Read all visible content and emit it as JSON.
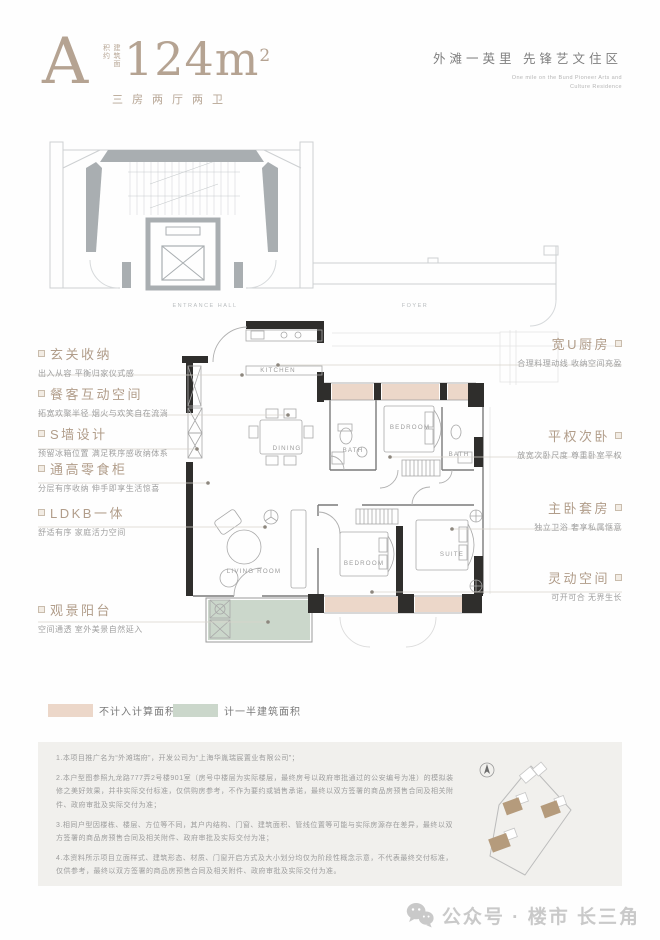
{
  "header": {
    "plan_letter": "A",
    "area_prefix": "建筑面积约",
    "area_value": "124m",
    "area_sup": "2",
    "layout": "三房两厅两卫",
    "tagline_cn": "外滩一英里  先锋艺文住区",
    "tagline_en_line1": "One mile on the Bund Pioneer Arts and",
    "tagline_en_line2": "Culture Residence"
  },
  "entrance": {
    "labels": [
      "ENTRANCE HALL",
      "FOYER"
    ]
  },
  "floorplan": {
    "rooms": [
      "KITCHEN",
      "DINING",
      "BATH",
      "BEDROOM",
      "BATH",
      "LIVING ROOM",
      "BEDROOM",
      "SUITE"
    ]
  },
  "callouts_left": [
    {
      "title": "玄关收纳",
      "desc": "出入从容 平衡归家仪式感"
    },
    {
      "title": "餐客互动空间",
      "desc": "拓宽欢聚半径 烟火与欢笑自在流淌"
    },
    {
      "title": "S墙设计",
      "desc": "预留冰箱位置 满足秩序感收纳体系"
    },
    {
      "title": "通高零食柜",
      "desc": "分层有序收纳 伸手即享生活惊喜"
    },
    {
      "title": "LDKB一体",
      "desc": "舒适有序 家庭活力空间"
    },
    {
      "title": "观景阳台",
      "desc": "空间通透 室外美景自然延入"
    }
  ],
  "callouts_right": [
    {
      "title": "宽U厨房",
      "desc": "合理料理动线 收纳空间充盈"
    },
    {
      "title": "平权次卧",
      "desc": "放宽次卧尺度 尊重卧室平权"
    },
    {
      "title": "主卧套房",
      "desc": "独立卫浴 奢享私属惬意"
    },
    {
      "title": "灵动空间",
      "desc": "可开可合 无界生长"
    }
  ],
  "legend": {
    "items": [
      {
        "label": "不计入计算面积",
        "color": "#ecd7c9"
      },
      {
        "label": "计一半建筑面积",
        "color": "#cbd7cb"
      }
    ]
  },
  "disclaimer": {
    "lines": [
      "1.本项目推广名为“外滩瑞府”，开发公司为“上海华胤瑞宸置业有限公司”；",
      "2.本户型图参照九龙路777弄2号楼901室（房号中楼层为实际楼层，最终房号以政府审批通过的公安编号为准）的模拟装修之美好效果，并非实际交付标准，仅供购房参考，不作为要约或销售承诺，最终以双方签署的商品房预售合同及相关附件、政府审批及实际交付为准；",
      "3.相同户型因楼栋、楼层、方位等不同，其户内结构、门窗、建筑面积、管线位置等可能与实际房源存在差异，最终以双方签署的商品房预售合同及相关附件、政府审批及实际交付为准；",
      "4.本资料所示项目立面样式、建筑形态、材质、门窗开启方式及大小划分均仅为阶段性概念示意，不代表最终交付标准，仅供参考，最终以双方签署的商品房预售合同及相关附件、政府审批及实际交付为准。"
    ]
  },
  "footer": {
    "watermark": "公众号 · 楼市 长三角"
  },
  "colors": {
    "accent": "#b5a392",
    "pink": "#ecd7c9",
    "green": "#cbd7cb",
    "wall": "#2f2e2c"
  }
}
